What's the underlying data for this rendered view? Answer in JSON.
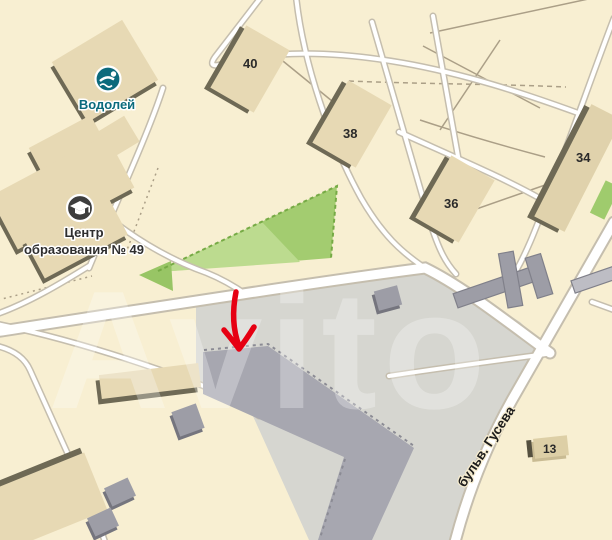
{
  "map": {
    "watermark_text": "Avito",
    "street_label": "бульв. Гусева",
    "pois": [
      {
        "label": "Водолей",
        "icon": "swimmer-icon",
        "accent_color": "#0c6a7c"
      },
      {
        "label_line1": "Центр",
        "label_line2": "образования № 49",
        "icon": "graduation-cap-icon",
        "accent_color": "#3d3d3d"
      }
    ],
    "building_numbers": [
      "40",
      "38",
      "36",
      "34",
      "13"
    ],
    "annotation": {
      "type": "down-arrow",
      "color": "#e60012"
    },
    "colors": {
      "background": "#f8efd2",
      "building_fill": "#e7d9b4",
      "building_shadow": "#6e6955",
      "industrial_zone": "#d6d6d0",
      "industrial_building": "#a7a7b0",
      "small_grey_building": "#9d9da6",
      "park_green": "#a3cc70",
      "park_green_light": "#bcdb8f",
      "road_fill": "#ffffff",
      "road_casing": "#c5beae",
      "poi_teal": "#0c6a7c",
      "arrow_red": "#e60012"
    }
  }
}
